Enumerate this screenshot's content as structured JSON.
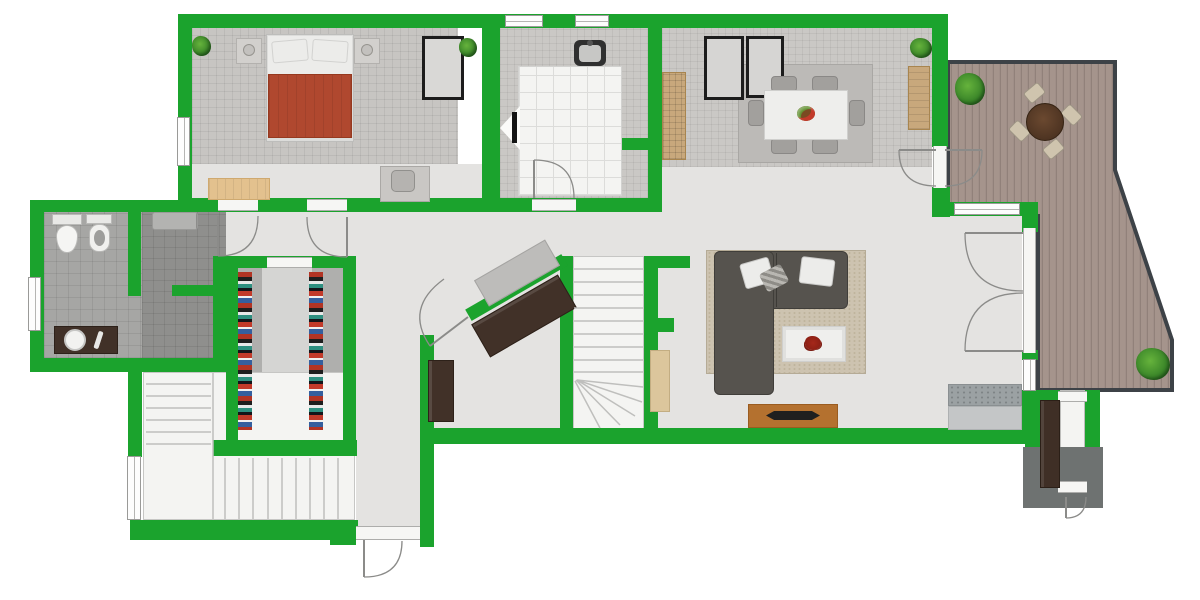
{
  "meta": {
    "kind": "architectural-floor-plan",
    "style": "2d-top-down",
    "visible_text": "none"
  },
  "colors": {
    "wall": "#1ba32d",
    "floorLight": "#e4e3e1",
    "tileGray": "#cac8c5",
    "carpetBed": "#c7c5c2",
    "bathTile": "#a6a6a4",
    "bathTileDark": "#8f8f8d",
    "closetFloor": "#afafad",
    "closetCenter": "#d5d5d3",
    "deckBase": "#a5948c",
    "deckLine": "#91817a",
    "deckBorder": "#3d4247",
    "white": "#f4f4f2",
    "rugDining": "#bcbab7",
    "rugLiving": "#cdc3b0",
    "rugSmall": "#dcc69c",
    "sofa": "#56534e",
    "pillow": "#ececea",
    "duvet": "#b0482f",
    "bedBase": "#dcdcda",
    "wood": "#b4712f",
    "darkWood": "#413128",
    "tan": "#e3c18e",
    "sideboardTan": "#c8a87c",
    "counterTop": "#9ba1a3",
    "counterBody": "#c4c6c7",
    "porch": "#6e7271",
    "plantDark": "#2f7a24",
    "plantLight": "#66b33c",
    "frameBlack": "#1c1c1c",
    "arcStroke": "#8b8b89",
    "sinkDark": "#303030",
    "accentRed": "#8c1f14"
  },
  "rooms": [
    {
      "id": "bedroom",
      "contents": [
        "double-bed",
        "nightstand-left",
        "nightstand-right",
        "wardrobe",
        "bench",
        "desk-with-chair",
        "plant",
        "plant"
      ]
    },
    {
      "id": "kitchen",
      "contents": [
        "kitchen-sink",
        "white-tiled-area",
        "wall-tv"
      ]
    },
    {
      "id": "dining-room",
      "contents": [
        "dining-table",
        "six-chairs",
        "fruit-bowl",
        "framed-panels",
        "sideboard",
        "runner-mat",
        "plant"
      ]
    },
    {
      "id": "deck-terrace",
      "contents": [
        "round-table",
        "four-chairs",
        "plant",
        "plant"
      ]
    },
    {
      "id": "bathroom",
      "contents": [
        "toilet",
        "bidet",
        "vanity-sink",
        "washer-unit",
        "shower-area"
      ]
    },
    {
      "id": "walk-in-closet",
      "contents": [
        "clothes-rack-left",
        "clothes-rack-right"
      ]
    },
    {
      "id": "living-room",
      "contents": [
        "l-shaped-sofa",
        "area-rug",
        "coffee-table-with-plant",
        "tv-sideboard",
        "small-rug",
        "kitchen-counter"
      ]
    },
    {
      "id": "hallway",
      "contents": [
        "diagonal-console",
        "diagonal-sideboard",
        "sideboard"
      ]
    },
    {
      "id": "staircase-main",
      "contents": [
        "straight-treads",
        "winder-treads"
      ]
    },
    {
      "id": "staircase-entry",
      "contents": [
        "upper-flight",
        "landing",
        "lower-flight"
      ]
    },
    {
      "id": "entry-vestibule-right",
      "contents": [
        "cabinet",
        "exterior-path",
        "door"
      ]
    }
  ],
  "doors": [
    "hall-left-door",
    "hall-right-door",
    "kitchen-door",
    "diagonal-hall-door",
    "dining-deck-double-door",
    "living-french-doors",
    "front-entry-door",
    "vestibule-door"
  ],
  "windows": [
    "bedroom-left-window",
    "kitchen-top-window-1",
    "kitchen-top-window-2",
    "bathroom-left-window",
    "entry-stairs-window",
    "living-north-window",
    "living-east-window"
  ]
}
